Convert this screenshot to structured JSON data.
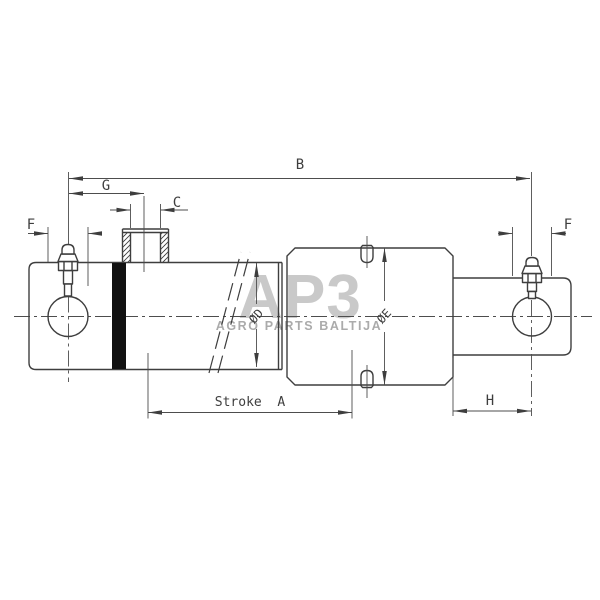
{
  "watermark": {
    "logo_text": "AP3",
    "tagline": "AGRO PARTS BALTIJA"
  },
  "dimensions": {
    "b": "B",
    "g": "G",
    "c": "C",
    "f_left": "F",
    "f_right": "F",
    "h": "H",
    "stroke_a": "Stroke  A",
    "diameter_d": "ØD",
    "diameter_e": "ØE"
  },
  "colors": {
    "background": "#ffffff",
    "object_line": "#3e3e3e",
    "dimension_line": "#4d4d4d",
    "seal_band": "#111111",
    "watermark_logo": "#c9c9c9",
    "watermark_tagline": "#ababab"
  }
}
